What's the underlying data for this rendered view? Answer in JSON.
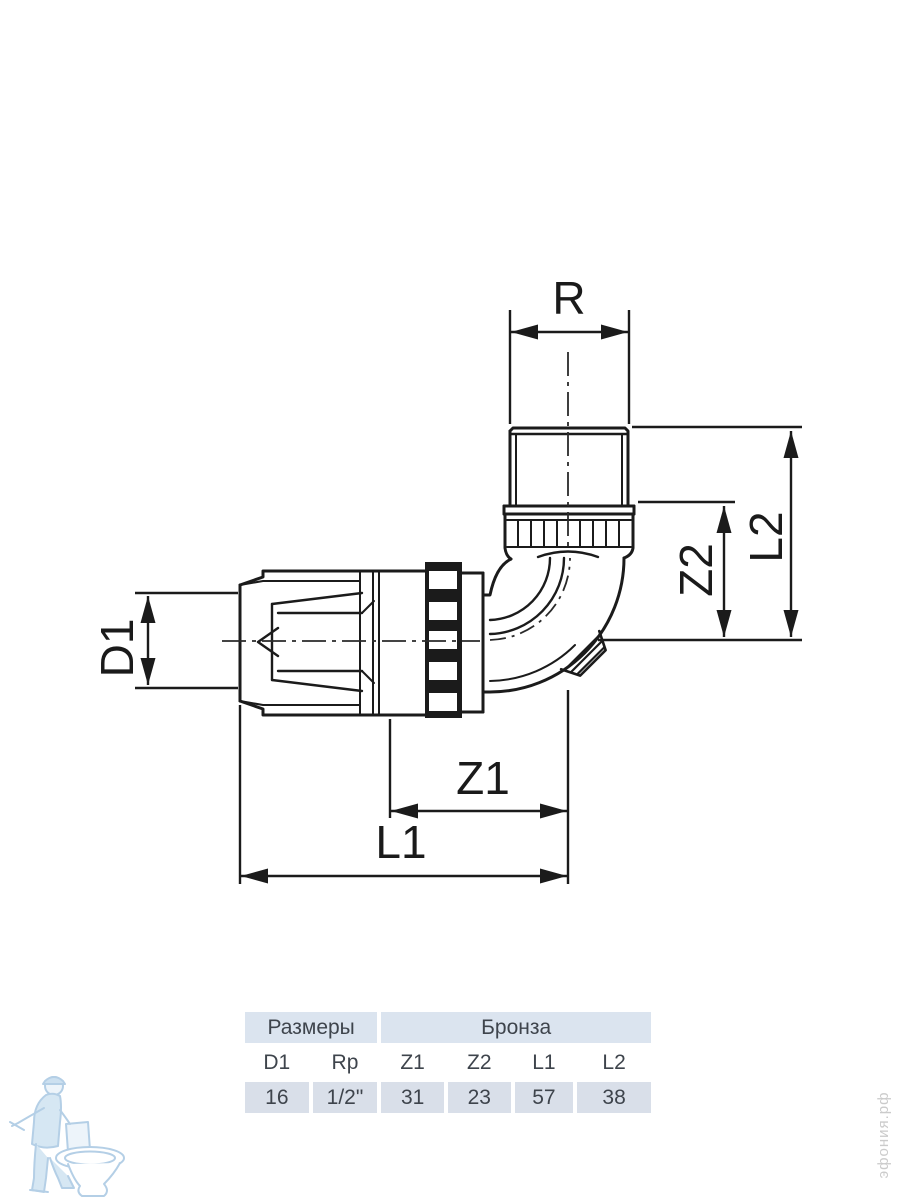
{
  "drawing": {
    "labels": {
      "r": "R",
      "l2": "L2",
      "z2": "Z2",
      "d1": "D1",
      "z1": "Z1",
      "l1": "L1"
    },
    "line_color": "#1b1b1b",
    "label_color": "#1a1a1a"
  },
  "table": {
    "group_headers": [
      {
        "label": "Размеры",
        "colspan": 2
      },
      {
        "label": "Бронза",
        "colspan": 4
      }
    ],
    "columns": [
      "D1",
      "Rp",
      "Z1",
      "Z2",
      "L1",
      "L2"
    ],
    "values": [
      "16",
      "1/2\"",
      "31",
      "23",
      "57",
      "38"
    ],
    "colors": {
      "group_header_bg": "#dbe4ef",
      "value_row_bg": "#d9dfe9",
      "text": "#3e444c"
    }
  },
  "watermarks": {
    "site": "эфония.рф"
  }
}
